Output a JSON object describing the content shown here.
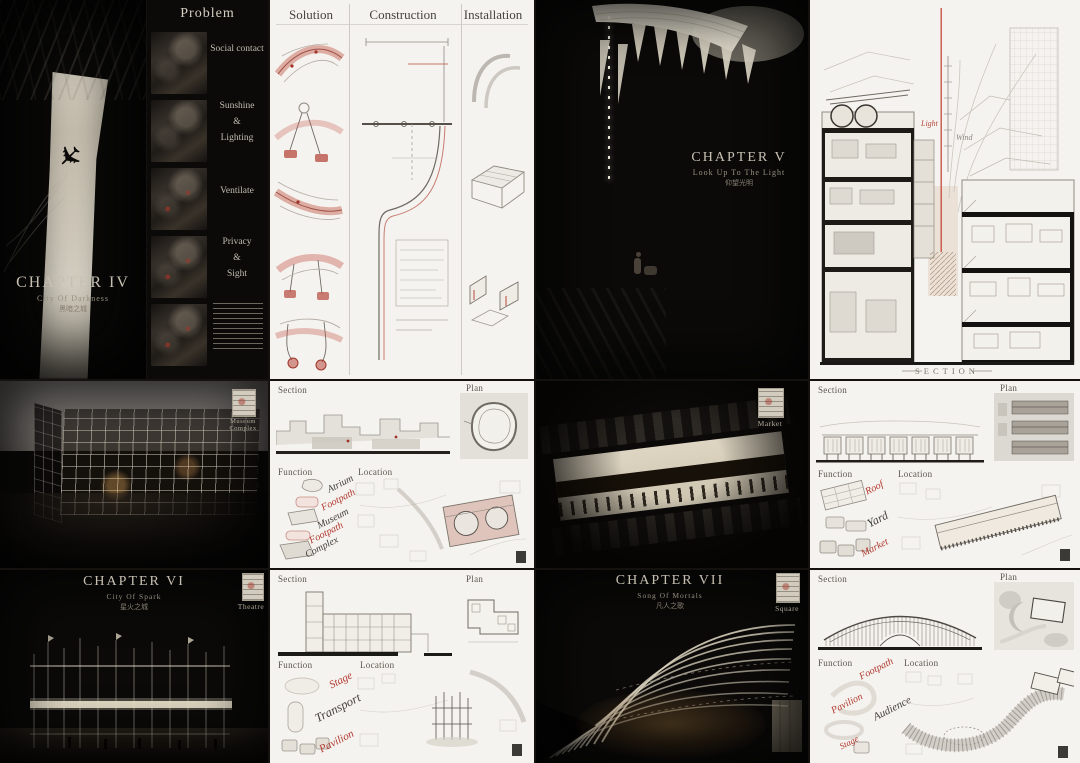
{
  "palette": {
    "red": "#b0392f",
    "paper": "#f5f3ef",
    "dark": "#0b0a09"
  },
  "chapter_iv": {
    "title": "CHAPTER IV",
    "subtitle": "City Of Darkness",
    "subtitle_cn": "黑暗之城"
  },
  "problem": {
    "title": "Problem",
    "item1": {
      "l1": "Social contact"
    },
    "item2": {
      "l1": "Sunshine",
      "l2": "&",
      "l3": "Lighting"
    },
    "item3": {
      "l1": "Ventilate"
    },
    "item4": {
      "l1": "Privacy",
      "l2": "&",
      "l3": "Sight"
    }
  },
  "studies": {
    "col1": "Solution",
    "col2": "Construction",
    "col3": "Installation"
  },
  "chapter_v": {
    "title": "CHAPTER V",
    "subtitle": "Look Up To The Light",
    "subtitle_cn": "仰望光明"
  },
  "big_section": {
    "light": "Light",
    "wind": "Wind",
    "light2": "Light",
    "caption": "SECTION"
  },
  "museum": {
    "section": "Section",
    "plan": "Plan",
    "function": "Function",
    "location": "Location",
    "f1": "Atrium",
    "f2": "Footpath",
    "f3": "Museum",
    "f4": "Footpath",
    "f5": "Complex",
    "stamp_l1": "Museum",
    "stamp_l2": "Complex"
  },
  "chapter_vi": {
    "title": "CHAPTER VI",
    "subtitle": "City Of Spark",
    "subtitle_cn": "星火之城",
    "stamp": "Theatre"
  },
  "theatre": {
    "section": "Section",
    "plan": "Plan",
    "function": "Function",
    "location": "Location",
    "f1": "Stage",
    "f2": "Transport",
    "f3": "Pavilion"
  },
  "market": {
    "section": "Section",
    "plan": "Plan",
    "function": "Function",
    "location": "Location",
    "f1": "Roof",
    "f2": "Yard",
    "f3": "Market",
    "stamp": "Market"
  },
  "chapter_vii": {
    "title": "CHAPTER VII",
    "subtitle": "Song Of Mortals",
    "subtitle_cn": "凡人之歌",
    "stamp": "Square"
  },
  "square": {
    "section": "Section",
    "plan": "Plan",
    "function": "Function",
    "location": "Location",
    "f1": "Footpath",
    "f2": "Pavilion",
    "f3": "Audience",
    "f4": "Stage"
  }
}
